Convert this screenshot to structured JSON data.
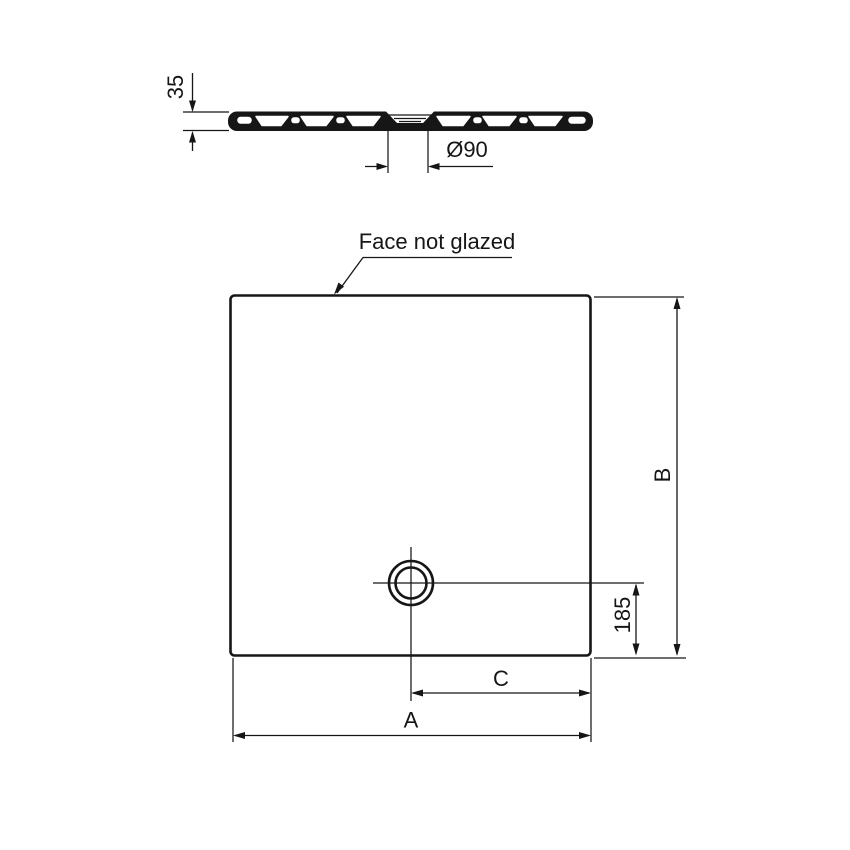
{
  "drawing": {
    "background": "#ffffff",
    "line_color": "#161616",
    "profile_view": {
      "thickness_dim": "35",
      "drain_diameter_dim": "Ø90"
    },
    "plan_view": {
      "face_note": "Face not glazed",
      "width_dim": "A",
      "depth_dim": "B",
      "drain_offset_horizontal_dim": "C",
      "drain_offset_vertical_dim": "185"
    }
  }
}
